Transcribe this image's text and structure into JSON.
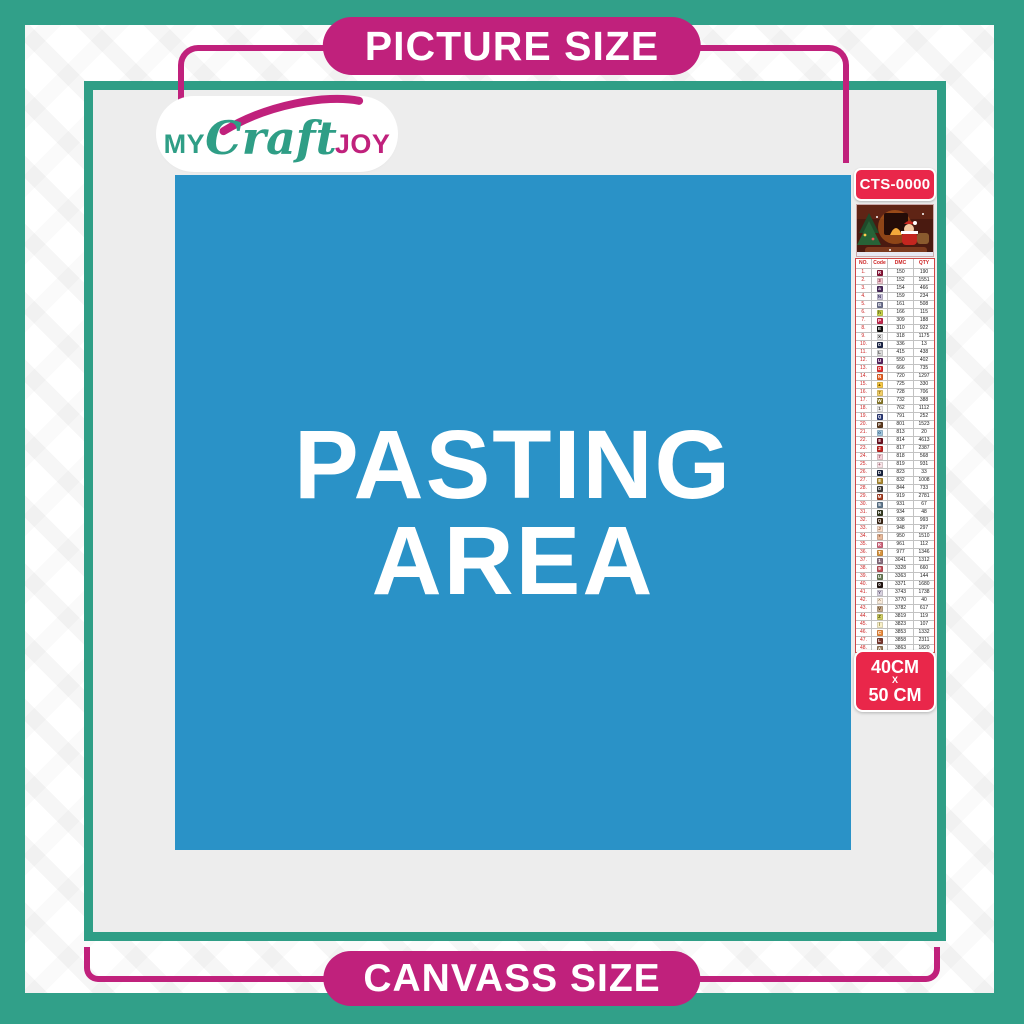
{
  "top_banner": {
    "label": "PICTURE SIZE"
  },
  "bottom_banner": {
    "label": "CANVASS SIZE"
  },
  "logo": {
    "word1": "MY",
    "word2": "Craft",
    "word3": "JOY"
  },
  "pasting_area": {
    "line1": "PASTING",
    "line2": "AREA"
  },
  "side_panel": {
    "product_code": "CTS-0000",
    "thumbnail": "christmas-santa-scene",
    "size_badge": {
      "line1": "40CM",
      "separator": "X",
      "line2": "50 CM"
    },
    "legend_table": {
      "headers": [
        "NO.",
        "Code",
        "DMC",
        "QTY"
      ],
      "rows": [
        {
          "no": "1.",
          "symbol": "R",
          "symbol_bg": "#8a1538",
          "symbol_fg": "#ffffff",
          "dmc": "150",
          "qty": "190"
        },
        {
          "no": "2.",
          "symbol": "3",
          "symbol_bg": "#f2c7cf",
          "symbol_fg": "#7a2040",
          "dmc": "152",
          "qty": "1551"
        },
        {
          "no": "3.",
          "symbol": "a",
          "symbol_bg": "#4a2b5e",
          "symbol_fg": "#ffffff",
          "dmc": "154",
          "qty": "466"
        },
        {
          "no": "4.",
          "symbol": "N",
          "symbol_bg": "#c9c2d9",
          "symbol_fg": "#3a3560",
          "dmc": "159",
          "qty": "234"
        },
        {
          "no": "5.",
          "symbol": "G",
          "symbol_bg": "#6e7390",
          "symbol_fg": "#ffffff",
          "dmc": "161",
          "qty": "508"
        },
        {
          "no": "6.",
          "symbol": "h",
          "symbol_bg": "#c8d44d",
          "symbol_fg": "#4a4a10",
          "dmc": "166",
          "qty": "115"
        },
        {
          "no": "7.",
          "symbol": "P",
          "symbol_bg": "#c62a4f",
          "symbol_fg": "#ffffff",
          "dmc": "309",
          "qty": "188"
        },
        {
          "no": "8.",
          "symbol": "E",
          "symbol_bg": "#111111",
          "symbol_fg": "#ffffff",
          "dmc": "310",
          "qty": "922"
        },
        {
          "no": "9.",
          "symbol": "X",
          "symbol_bg": "#e8e8e8",
          "symbol_fg": "#333333",
          "dmc": "318",
          "qty": "1175"
        },
        {
          "no": "10.",
          "symbol": "O",
          "symbol_bg": "#1c2749",
          "symbol_fg": "#ffffff",
          "dmc": "336",
          "qty": "13"
        },
        {
          "no": "11.",
          "symbol": "L",
          "symbol_bg": "#dcdcdc",
          "symbol_fg": "#444444",
          "dmc": "415",
          "qty": "438"
        },
        {
          "no": "12.",
          "symbol": "U",
          "symbol_bg": "#5a2562",
          "symbol_fg": "#ffffff",
          "dmc": "550",
          "qty": "402"
        },
        {
          "no": "13.",
          "symbol": "O",
          "symbol_bg": "#e53030",
          "symbol_fg": "#ffffff",
          "dmc": "666",
          "qty": "735"
        },
        {
          "no": "14.",
          "symbol": "N",
          "symbol_bg": "#e96325",
          "symbol_fg": "#ffffff",
          "dmc": "720",
          "qty": "1297"
        },
        {
          "no": "15.",
          "symbol": "▲",
          "symbol_bg": "#f7c948",
          "symbol_fg": "#7a5a00",
          "dmc": "725",
          "qty": "330"
        },
        {
          "no": "16.",
          "symbol": "7",
          "symbol_bg": "#f3d06a",
          "symbol_fg": "#7a5a00",
          "dmc": "728",
          "qty": "706"
        },
        {
          "no": "17.",
          "symbol": "W",
          "symbol_bg": "#8a7a28",
          "symbol_fg": "#ffffff",
          "dmc": "732",
          "qty": "388"
        },
        {
          "no": "18.",
          "symbol": "1",
          "symbol_bg": "#efefef",
          "symbol_fg": "#555555",
          "dmc": "762",
          "qty": "1112"
        },
        {
          "no": "19.",
          "symbol": "Q",
          "symbol_bg": "#2c3a78",
          "symbol_fg": "#ffffff",
          "dmc": "791",
          "qty": "252"
        },
        {
          "no": "20.",
          "symbol": "F",
          "symbol_bg": "#5d3a1e",
          "symbol_fg": "#ffffff",
          "dmc": "801",
          "qty": "1523"
        },
        {
          "no": "21.",
          "symbol": "o",
          "symbol_bg": "#a3c8e0",
          "symbol_fg": "#27557a",
          "dmc": "813",
          "qty": "20"
        },
        {
          "no": "22.",
          "symbol": "8",
          "symbol_bg": "#6e1020",
          "symbol_fg": "#ffffff",
          "dmc": "814",
          "qty": "4613"
        },
        {
          "no": "23.",
          "symbol": "2",
          "symbol_bg": "#c22723",
          "symbol_fg": "#ffffff",
          "dmc": "817",
          "qty": "2387"
        },
        {
          "no": "24.",
          "symbol": "7",
          "symbol_bg": "#f6d2da",
          "symbol_fg": "#8a4a5a",
          "dmc": "818",
          "qty": "568"
        },
        {
          "no": "25.",
          "symbol": "+",
          "symbol_bg": "#f9e4e8",
          "symbol_fg": "#8a4a5a",
          "dmc": "819",
          "qty": "931"
        },
        {
          "no": "26.",
          "symbol": "D",
          "symbol_bg": "#17233f",
          "symbol_fg": "#ffffff",
          "dmc": "823",
          "qty": "33"
        },
        {
          "no": "27.",
          "symbol": "8",
          "symbol_bg": "#ad8a2f",
          "symbol_fg": "#ffffff",
          "dmc": "832",
          "qty": "1008"
        },
        {
          "no": "28.",
          "symbol": "O",
          "symbol_bg": "#3e3e3e",
          "symbol_fg": "#ffffff",
          "dmc": "844",
          "qty": "733"
        },
        {
          "no": "29.",
          "symbol": "M",
          "symbol_bg": "#a63c1e",
          "symbol_fg": "#ffffff",
          "dmc": "919",
          "qty": "2781"
        },
        {
          "no": "30.",
          "symbol": "5",
          "symbol_bg": "#61798f",
          "symbol_fg": "#ffffff",
          "dmc": "931",
          "qty": "67"
        },
        {
          "no": "31.",
          "symbol": "H",
          "symbol_bg": "#363c22",
          "symbol_fg": "#ffffff",
          "dmc": "934",
          "qty": "48"
        },
        {
          "no": "32.",
          "symbol": "Q",
          "symbol_bg": "#3a2413",
          "symbol_fg": "#ffffff",
          "dmc": "938",
          "qty": "993"
        },
        {
          "no": "33.",
          "symbol": "J",
          "symbol_bg": "#f7dcc9",
          "symbol_fg": "#8a5a3a",
          "dmc": "948",
          "qty": "297"
        },
        {
          "no": "34.",
          "symbol": "*",
          "symbol_bg": "#e9bb9d",
          "symbol_fg": "#7a4a2a",
          "dmc": "950",
          "qty": "1510"
        },
        {
          "no": "35.",
          "symbol": "K",
          "symbol_bg": "#d2677e",
          "symbol_fg": "#ffffff",
          "dmc": "961",
          "qty": "112"
        },
        {
          "no": "36.",
          "symbol": "T",
          "symbol_bg": "#d89540",
          "symbol_fg": "#ffffff",
          "dmc": "977",
          "qty": "1346"
        },
        {
          "no": "37.",
          "symbol": "1",
          "symbol_bg": "#8a6f80",
          "symbol_fg": "#ffffff",
          "dmc": "3041",
          "qty": "1312"
        },
        {
          "no": "38.",
          "symbol": "9",
          "symbol_bg": "#c25059",
          "symbol_fg": "#ffffff",
          "dmc": "3328",
          "qty": "660"
        },
        {
          "no": "39.",
          "symbol": "U",
          "symbol_bg": "#6d7f5a",
          "symbol_fg": "#ffffff",
          "dmc": "3363",
          "qty": "144"
        },
        {
          "no": "40.",
          "symbol": "0",
          "symbol_bg": "#231511",
          "symbol_fg": "#ffffff",
          "dmc": "3371",
          "qty": "1680"
        },
        {
          "no": "41.",
          "symbol": "Y",
          "symbol_bg": "#d9d3e0",
          "symbol_fg": "#5a5070",
          "dmc": "3743",
          "qty": "1738"
        },
        {
          "no": "42.",
          "symbol": "^",
          "symbol_bg": "#f9ecdc",
          "symbol_fg": "#8a6a4a",
          "dmc": "3770",
          "qty": "40"
        },
        {
          "no": "43.",
          "symbol": "V",
          "symbol_bg": "#c3a98b",
          "symbol_fg": "#5a3f23",
          "dmc": "3782",
          "qty": "617"
        },
        {
          "no": "44.",
          "symbol": "Z",
          "symbol_bg": "#d2d168",
          "symbol_fg": "#4a4a10",
          "dmc": "3819",
          "qty": "119"
        },
        {
          "no": "45.",
          "symbol": "/",
          "symbol_bg": "#f8f0c9",
          "symbol_fg": "#7a6a20",
          "dmc": "3823",
          "qty": "107"
        },
        {
          "no": "46.",
          "symbol": "C",
          "symbol_bg": "#ec8c3e",
          "symbol_fg": "#ffffff",
          "dmc": "3853",
          "qty": "1332"
        },
        {
          "no": "47.",
          "symbol": "L",
          "symbol_bg": "#7b382f",
          "symbol_fg": "#ffffff",
          "dmc": "3858",
          "qty": "2311"
        },
        {
          "no": "48.",
          "symbol": "A",
          "symbol_bg": "#9b7d5e",
          "symbol_fg": "#ffffff",
          "dmc": "3863",
          "qty": "1820"
        }
      ]
    }
  },
  "colors": {
    "teal": "#31a089",
    "magenta": "#c0217c",
    "pasting_blue": "#2a92c7",
    "badge_red": "#e9274a",
    "canvas_gray": "#ededed",
    "table_accent_red": "#cc2222"
  }
}
